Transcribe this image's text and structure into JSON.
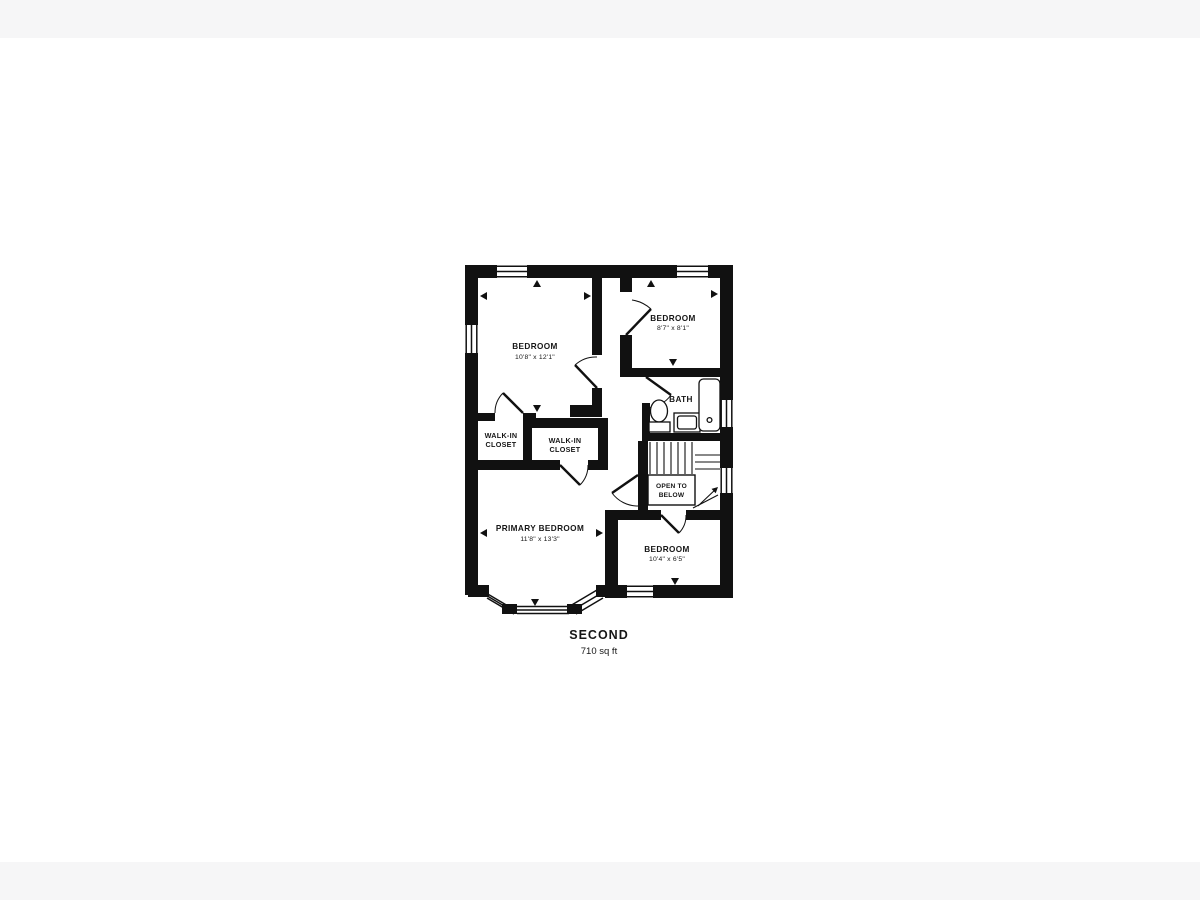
{
  "page": {
    "background_color": "#f6f6f7",
    "canvas_color": "#ffffff",
    "ink_color": "#111111"
  },
  "floorplan": {
    "floor_title": "SECOND",
    "floor_area": "710 sq ft",
    "rooms": {
      "bedroom_top_left": {
        "name": "BEDROOM",
        "dims": "10'8\" x 12'1\""
      },
      "bedroom_top_right": {
        "name": "BEDROOM",
        "dims": "8'7\" x 8'1\""
      },
      "bath": {
        "name": "BATH"
      },
      "walk_in_closet_left": {
        "name_line1": "WALK-IN",
        "name_line2": "CLOSET"
      },
      "walk_in_closet_right": {
        "name_line1": "WALK-IN",
        "name_line2": "CLOSET"
      },
      "open_to_below": {
        "name_line1": "OPEN TO",
        "name_line2": "BELOW"
      },
      "primary_bedroom": {
        "name": "PRIMARY BEDROOM",
        "dims": "11'8\" x 13'3\""
      },
      "bedroom_bottom_right": {
        "name": "BEDROOM",
        "dims": "10'4\" x 6'5\""
      }
    },
    "features": [
      "stairs",
      "bay-window",
      "toilet",
      "sink",
      "bathtub",
      "windows",
      "door-swings"
    ]
  }
}
